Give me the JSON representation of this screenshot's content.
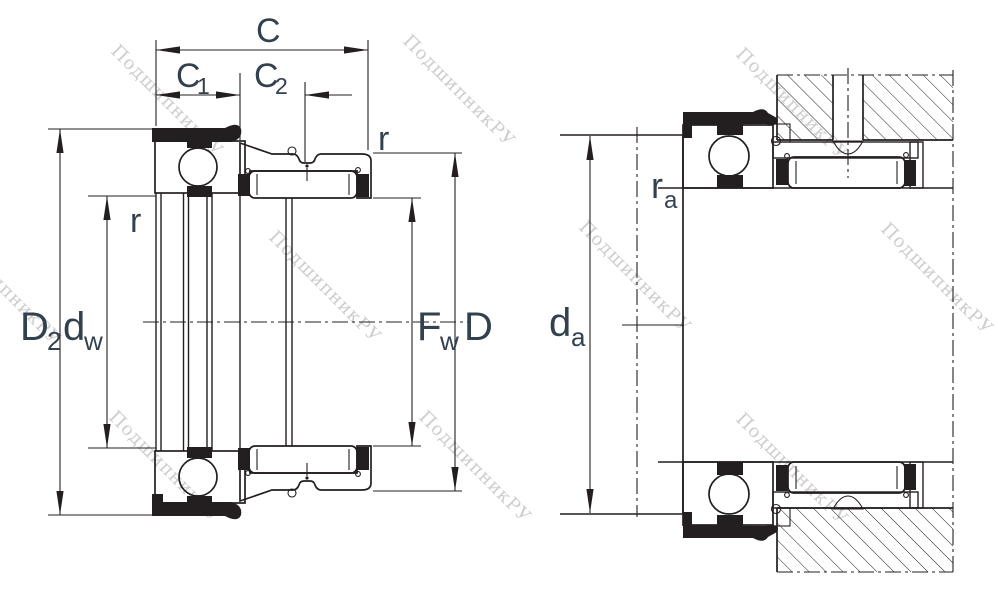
{
  "colors": {
    "line": "#231f20",
    "label": "#33404e",
    "watermark": "#c8c8c8",
    "background": "#ffffff"
  },
  "watermark": {
    "text": "ПодшипникРУ"
  },
  "left_view": {
    "labels": {
      "C": "C",
      "C1": {
        "main": "C",
        "sub": "1"
      },
      "C2": {
        "main": "C",
        "sub": "2"
      },
      "r_outer": "r",
      "r_bore": "r",
      "D2": {
        "main": "D",
        "sub": "2"
      },
      "dw": {
        "main": "d",
        "sub": "w"
      },
      "Fw": {
        "main": "F",
        "sub": "w"
      },
      "D": "D"
    }
  },
  "right_view": {
    "labels": {
      "da": {
        "main": "d",
        "sub": "a"
      },
      "ra": {
        "main": "r",
        "sub": "a"
      }
    }
  }
}
